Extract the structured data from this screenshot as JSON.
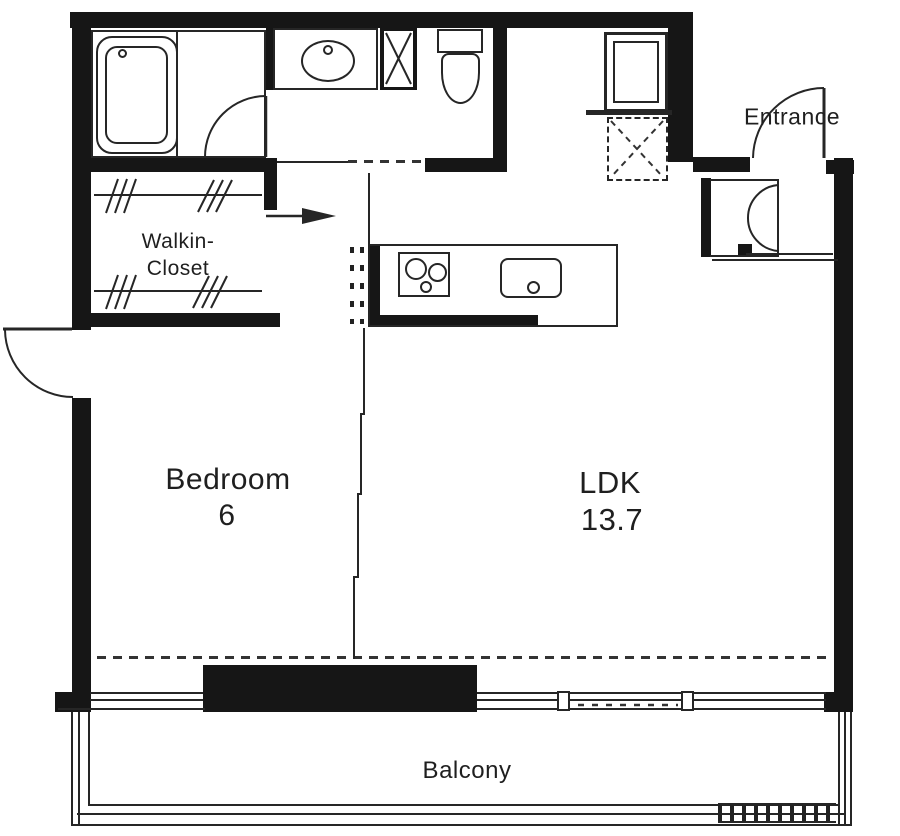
{
  "rooms": {
    "bedroom": {
      "name": "Bedroom",
      "size": "6"
    },
    "ldk": {
      "name": "LDK",
      "size": "13.7"
    },
    "walk_in_closet": {
      "name_line1": "Walkin-",
      "name_line2": "Closet"
    },
    "entrance": {
      "name": "Entrance"
    },
    "balcony": {
      "name": "Balcony"
    }
  },
  "colors": {
    "wall": "#161616",
    "line": "#262626",
    "text": "#1f1f1f",
    "background": "#ffffff"
  }
}
